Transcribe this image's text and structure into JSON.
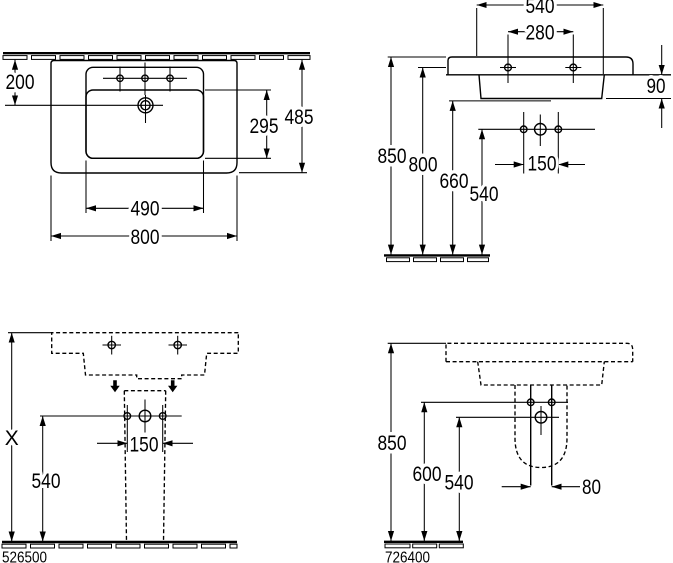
{
  "title": "Washbasin technical dimension drawing",
  "colors": {
    "line": "#000000",
    "background": "#ffffff"
  },
  "views": {
    "plan": {
      "dims": {
        "wall_to_drain": "200",
        "bowl_depth": "295",
        "overall_depth": "485",
        "bowl_width": "490",
        "overall_width": "800"
      }
    },
    "front": {
      "dims": {
        "upper_width": "540",
        "fixing_hole_spacing": "280",
        "apron_height": "90",
        "rim_height": "850",
        "fixing_height": "800",
        "underside_height": "660",
        "outlet_height": "540",
        "outlet_hole_spacing": "150"
      }
    },
    "pedestal_front": {
      "part_number": "526500",
      "dims": {
        "overall_height": "X",
        "outlet_height": "540",
        "outlet_hole_spacing": "150"
      }
    },
    "pedestal_side": {
      "part_number": "726400",
      "dims": {
        "rim_height": "850",
        "fixing_height": "600",
        "outlet_height": "540",
        "outlet_width": "80"
      }
    }
  }
}
